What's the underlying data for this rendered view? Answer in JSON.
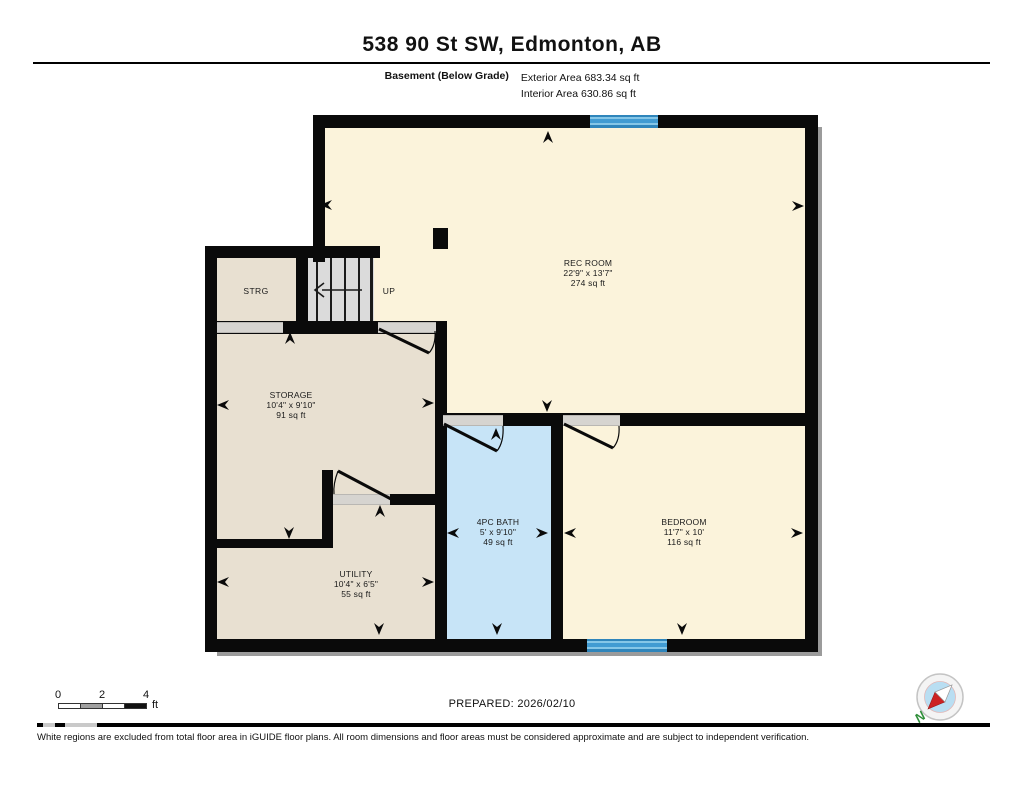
{
  "header": {
    "title": "538 90 St SW, Edmonton, AB",
    "floor_label": "Basement (Below Grade)",
    "exterior_area": "Exterior Area 683.34 sq ft",
    "interior_area": "Interior Area 630.86 sq ft"
  },
  "rooms": [
    {
      "name": "REC ROOM",
      "dims": "22'9\" x 13'7\"",
      "area": "274 sq ft"
    },
    {
      "name": "STRG"
    },
    {
      "name": "STORAGE",
      "dims": "10'4\" x 9'10\"",
      "area": "91 sq ft"
    },
    {
      "name": "4PC BATH",
      "dims": "5' x 9'10\"",
      "area": "49 sq ft"
    },
    {
      "name": "BEDROOM",
      "dims": "11'7\" x 10'",
      "area": "116 sq ft"
    },
    {
      "name": "UTILITY",
      "dims": "10'4\" x 6'5\"",
      "area": "55 sq ft"
    }
  ],
  "stairs": {
    "direction_label": "UP"
  },
  "scale_bar": {
    "tick0": "0",
    "tick1": "2",
    "tick2": "4",
    "unit": "ft"
  },
  "prepared_label": "PREPARED: 2026/02/10",
  "compass": {
    "north_label": "N"
  },
  "footer": {
    "disclaimer": "White regions are excluded from total floor area in iGUIDE floor plans. All room dimensions and floor areas must be considered approximate and are subject to independent verification."
  },
  "colors": {
    "wall_black": "#0A0A0A",
    "room_cream": "#FBF3DB",
    "room_beige": "#E8E0D1",
    "room_bath_blue": "#C7E4F7",
    "stairs_gray": "#DBDBDB",
    "window_blue": "#419BD2",
    "compass_north_green": "#2F8F3A"
  }
}
